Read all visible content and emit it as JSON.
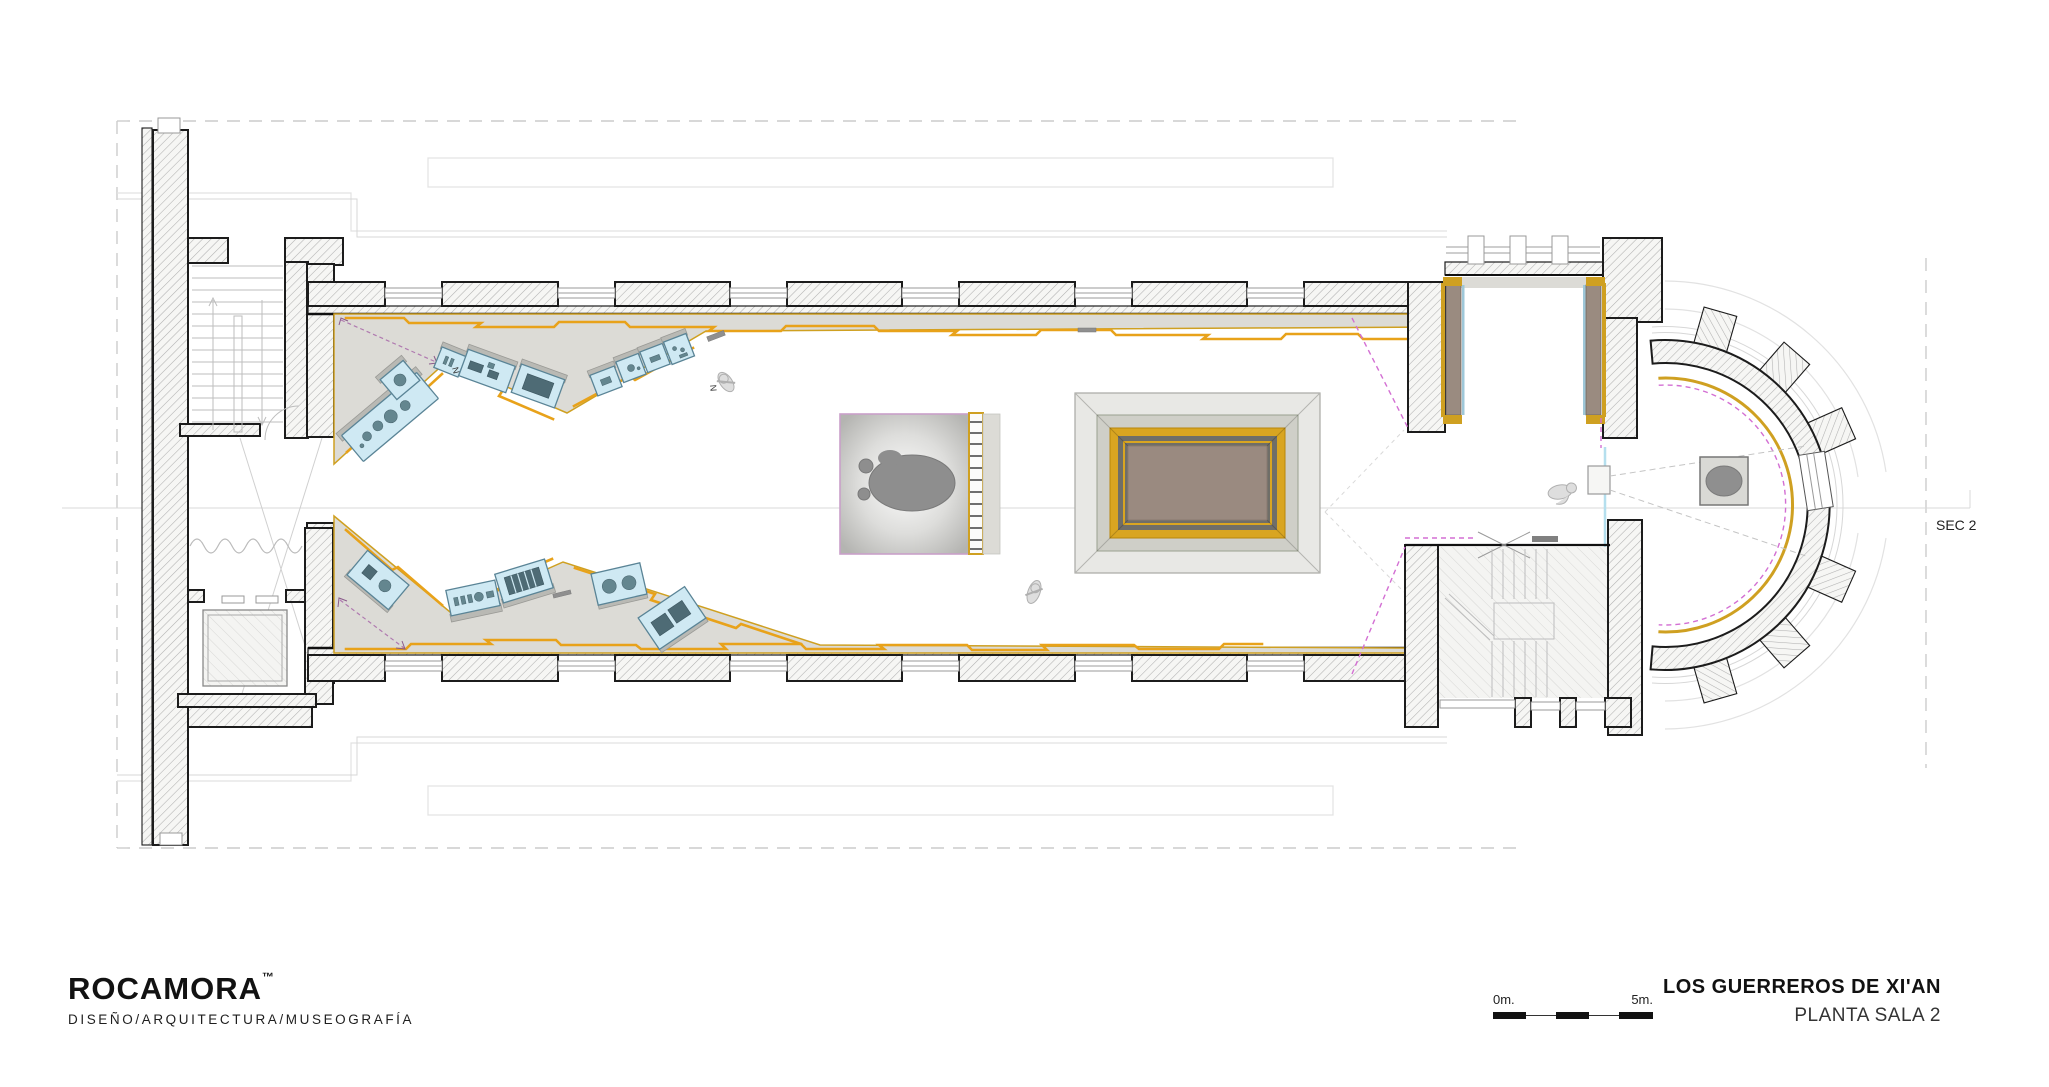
{
  "branding": {
    "name": "ROCAMORA",
    "trademark": "™",
    "tagline": "DISEÑO/ARQUITECTURA/MUSEOGRAFÍA"
  },
  "title_block": {
    "project": "LOS GUERREROS DE XI'AN",
    "sheet": "PLANTA SALA 2"
  },
  "scale_bar": {
    "start_label": "0m.",
    "end_label": "5m."
  },
  "annotations": {
    "section_label": "SEC 2",
    "vitrine_mark": "N"
  },
  "palette": {
    "accent_gold": "#cfa021",
    "zigzag_orange": "#e8a21a",
    "floor_band_gray": "#dcdbd6",
    "vitrine_blue": "#cfe9f3",
    "vitrine_object": "#64868f",
    "magenta_guide": "#d36fd3",
    "pit_center_brown": "#9a8a80",
    "cyan_partition": "#b5dfee",
    "wall_hatch": "#b0b0b0"
  }
}
